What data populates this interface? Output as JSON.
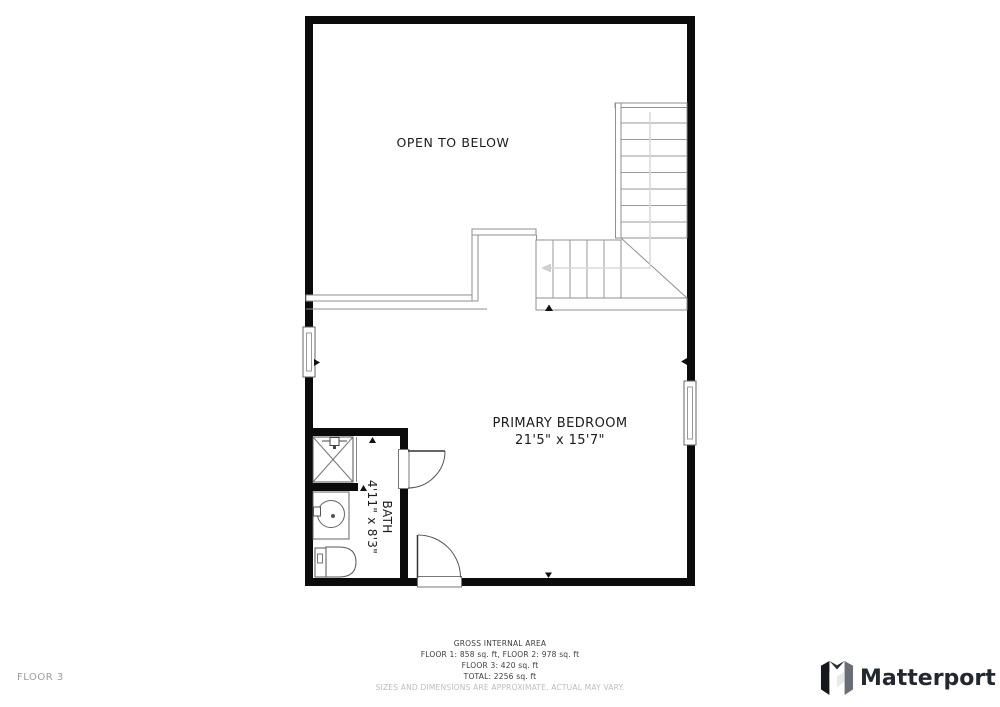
{
  "floor_plan": {
    "rooms": {
      "open_to_below": {
        "label": "OPEN TO BELOW"
      },
      "primary_bedroom": {
        "label": "PRIMARY BEDROOM",
        "dimensions": "21'5\" x 15'7\""
      },
      "bath": {
        "label": "BATH",
        "dimensions": "4'11\" x 8'3\""
      }
    },
    "features": [
      "staircase",
      "stair-winder",
      "railing-open-to-below",
      "left-window",
      "right-window",
      "bath-door",
      "bedroom-door",
      "shower",
      "vanity-sink",
      "toilet"
    ]
  },
  "footer": {
    "area_summary": {
      "title": "GROSS INTERNAL AREA",
      "line1": "FLOOR 1: 858 sq. ft, FLOOR 2: 978 sq. ft",
      "line2": "FLOOR 3: 420 sq. ft",
      "line3": "TOTAL: 2256 sq. ft",
      "disclaimer": "SIZES AND DIMENSIONS ARE APPROXIMATE, ACTUAL MAY VARY."
    },
    "floor_label": "FLOOR 3",
    "brand": {
      "name": "Matterport",
      "logo_icon": "matterport-m-logo"
    }
  },
  "colors": {
    "wall": "#0b0b0b",
    "thin_line": "#8f8f8f",
    "fixture_line": "#555555",
    "guide_arrow": "#d2d2d2",
    "text": "#1c1c1c",
    "footer_text": "#3d3d3d",
    "disclaimer_text": "#bcbcbc",
    "muted_label": "#9c9c9c",
    "brand_text": "#23272e"
  }
}
